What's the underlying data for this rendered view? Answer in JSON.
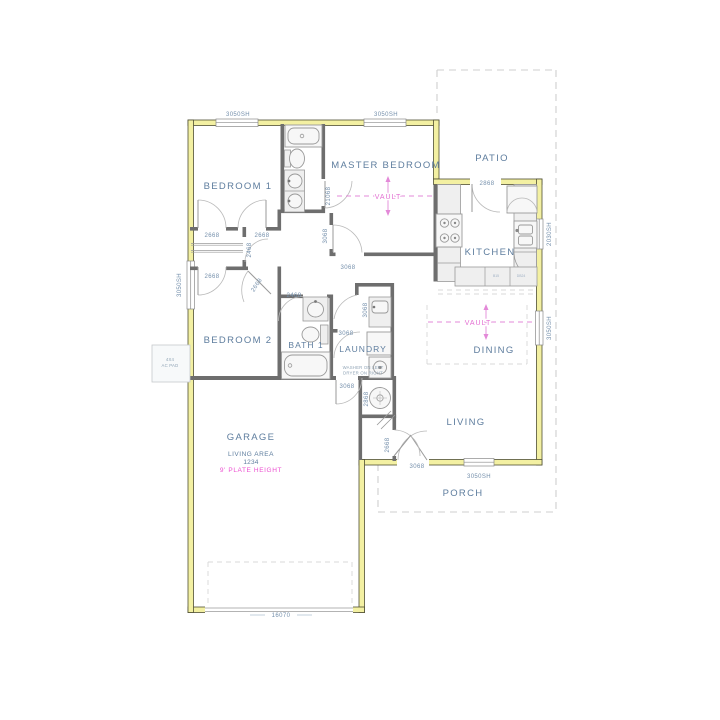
{
  "plan_title": "single-story house floor plan",
  "colors": {
    "exterior_wall": "#f3f0a2",
    "interior_wall": "#6e6e6e",
    "room_text": "#5e7d9e",
    "dimension_text": "#748fab",
    "vault_accent": "#e36ed2",
    "plate_height_accent": "#ec4fd0",
    "dashed_outline": "#cfcfcf"
  },
  "rooms": {
    "bedroom1": "BEDROOM 1",
    "master": "MASTER BEDROOM",
    "patio": "PATIO",
    "kitchen": "KITCHEN",
    "dining": "DINING",
    "living": "LIVING",
    "bedroom2": "BEDROOM 2",
    "bath1": "BATH 1",
    "laundry": "LAUNDRY",
    "garage": "GARAGE",
    "porch": "PORCH"
  },
  "windows": {
    "bedroom1_top": "3050SH",
    "master_top": "3050SH",
    "bedroom2_left": "3050SH",
    "kitchen_right": "2030SH",
    "dining_right": "3050SH",
    "porch_front": "3050SH"
  },
  "doors": {
    "garage_overhead": "16070",
    "patio": "2868",
    "bedroom1": "2668",
    "hall_closet_top": "2668",
    "hall_closet_side": "2468",
    "bedroom2": "2668",
    "hall_angled": "2668",
    "bath1": "2468",
    "master_bath": "21068",
    "master_v": "3068",
    "master_h": "3068",
    "utility_closet": "3068",
    "laundry": "3068",
    "laundry_garage": "3068",
    "water_heater": "2868",
    "entry_interior": "2668",
    "front": "3068"
  },
  "annotations": {
    "vault_master": "VAULT",
    "vault_dining": "VAULT",
    "living_area_label": "LIVING AREA",
    "living_area_value": "1234",
    "plate_height": "9' PLATE HEIGHT",
    "laundry_note1": "WASHER ON LEFT",
    "laundry_note2": "DRYER ON RIGHT",
    "ac_pad_line1": "4X4",
    "ac_pad_line2": "AC PAD",
    "cabinet_a": "B15",
    "cabinet_b": "DB24"
  }
}
